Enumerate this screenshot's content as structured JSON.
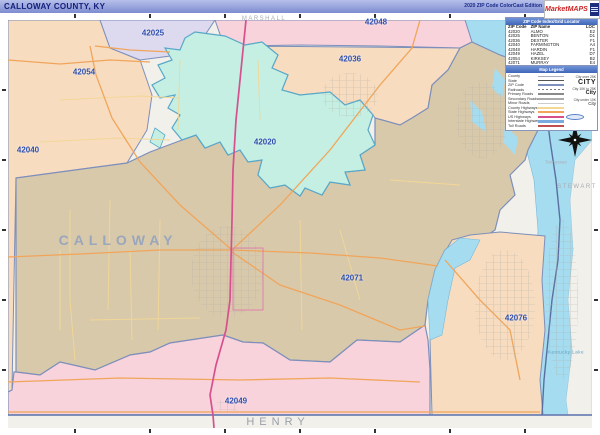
{
  "title_bar": {
    "title": "CALLOWAY COUNTY, KY",
    "edition": "2020 ZIP Code ColorCast Edition",
    "logo_text": "MarketMAPS"
  },
  "zip_index": {
    "header": "ZIP Code Index/Grid Locator",
    "columns": [
      "ZIP Code",
      "ZIP Name",
      "LOC"
    ],
    "rows": [
      [
        "42020",
        "ALMO",
        "E2"
      ],
      [
        "42025",
        "BENTON",
        "D1"
      ],
      [
        "42036",
        "DEXTER",
        "F1"
      ],
      [
        "42040",
        "FARMINGTON",
        "A4"
      ],
      [
        "42048",
        "HARDIN",
        "F1"
      ],
      [
        "42049",
        "HAZEL",
        "D7"
      ],
      [
        "42054",
        "KIRKSEY",
        "B2"
      ],
      [
        "42071",
        "MURRAY",
        "E4"
      ],
      [
        "42076",
        "NEW CONCORD",
        "I5"
      ]
    ]
  },
  "map_legend": {
    "header": "Map Legend",
    "road_items": [
      {
        "label": "County",
        "style": "county"
      },
      {
        "label": "State",
        "style": "state"
      },
      {
        "label": "ZIP Code",
        "style": "zip"
      },
      {
        "label": "Railroads",
        "style": "rail"
      },
      {
        "label": "Primary Roads",
        "style": "primary"
      },
      {
        "label": "Secondary Roads",
        "style": "secondary"
      },
      {
        "label": "Minor Roads",
        "style": "minor"
      },
      {
        "label": "County Highways",
        "style": "county-hwy"
      },
      {
        "label": "State Highways",
        "style": "state-hwy"
      },
      {
        "label": "US Highways",
        "style": "us-hwy"
      },
      {
        "label": "Interstate Highways",
        "style": "interstate"
      },
      {
        "label": "Toll Roads",
        "style": "toll"
      }
    ],
    "city_items": [
      {
        "label": "City over 25K",
        "sample": "CITY"
      },
      {
        "label": "City 10K to 25K",
        "sample": "City"
      },
      {
        "label": "City under 10K",
        "sample": "City"
      }
    ]
  },
  "map": {
    "zip_labels": [
      {
        "code": "42048",
        "x": 376,
        "y": 22
      },
      {
        "code": "42025",
        "x": 153,
        "y": 33
      },
      {
        "code": "42036",
        "x": 350,
        "y": 59
      },
      {
        "code": "42054",
        "x": 84,
        "y": 72
      },
      {
        "code": "42040",
        "x": 28,
        "y": 150
      },
      {
        "code": "42020",
        "x": 265,
        "y": 142
      },
      {
        "code": "42071",
        "x": 352,
        "y": 278
      },
      {
        "code": "42076",
        "x": 516,
        "y": 318
      },
      {
        "code": "42049",
        "x": 236,
        "y": 401
      }
    ],
    "place_labels": [
      {
        "text": "CALLOWAY",
        "x": 118,
        "y": 240,
        "kind": "county"
      },
      {
        "text": "HENRY",
        "x": 278,
        "y": 422,
        "kind": "neighbor"
      },
      {
        "text": "MARSHALL",
        "x": 264,
        "y": 19,
        "kind": "neighbor-sm"
      },
      {
        "text": "STEWART",
        "x": 577,
        "y": 187,
        "kind": "neighbor-sm"
      },
      {
        "text": "Tennessee",
        "x": 556,
        "y": 162,
        "kind": "state"
      },
      {
        "text": "Kentucky Lake",
        "x": 566,
        "y": 352,
        "kind": "water"
      }
    ]
  },
  "colors": {
    "peach": "#f7dcc0",
    "lavender": "#ddd9ef",
    "mint": "#c5efe2",
    "tan": "#d9c9ab",
    "pink": "#f9d3dc",
    "lake": "#a5dcf0",
    "outside": "#f1f0ea",
    "border": "#7d8fba",
    "zip_label": "#2d4fae",
    "us_highway": "#d6508e",
    "state_highway": "#f0a55a",
    "minor_road": "#f2d795"
  }
}
